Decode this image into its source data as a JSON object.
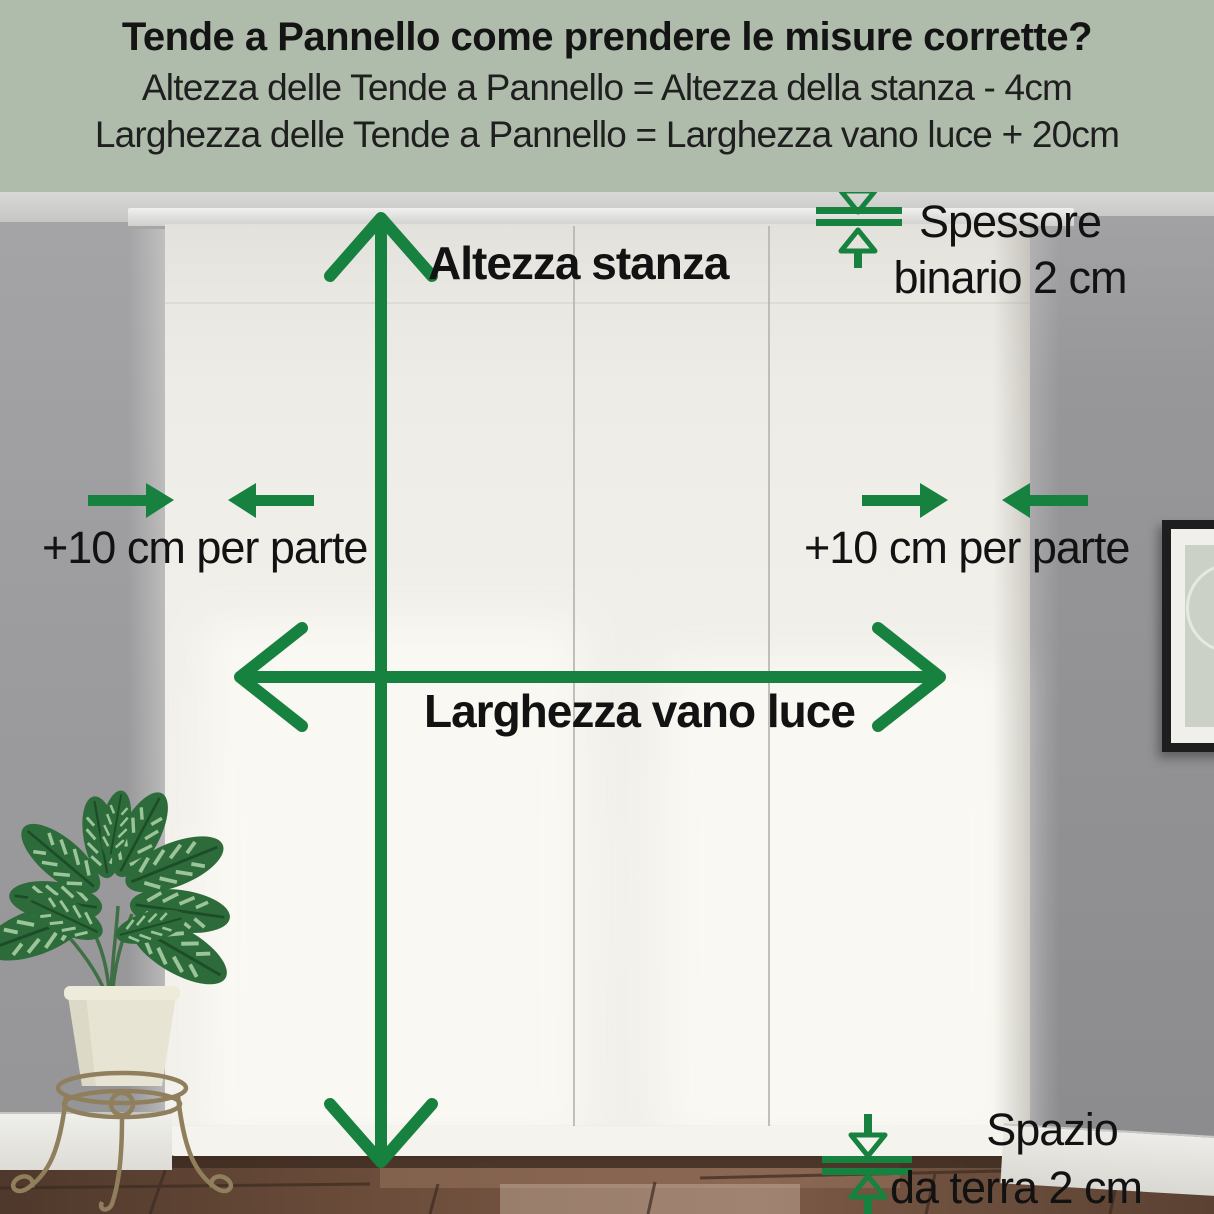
{
  "header": {
    "title": "Tende a Pannello come prendere le misure corrette?",
    "formula_height": "Altezza delle Tende a Pannello = Altezza della stanza - 4cm",
    "formula_width": "Larghezza delle Tende a Pannello = Larghezza vano luce + 20cm"
  },
  "annotations": {
    "room_height": "Altezza stanza",
    "opening_width": "Larghezza vano luce",
    "left_extension": "+10 cm per parte",
    "right_extension": "+10 cm per parte",
    "track_thickness_line1": "Spessore",
    "track_thickness_line2": "binario 2 cm",
    "floor_gap_line1": "Spazio",
    "floor_gap_line2": "da terra 2 cm"
  },
  "colors": {
    "header_background": "#afbcab",
    "arrow_green": "#17813f",
    "text_black": "#141414"
  }
}
